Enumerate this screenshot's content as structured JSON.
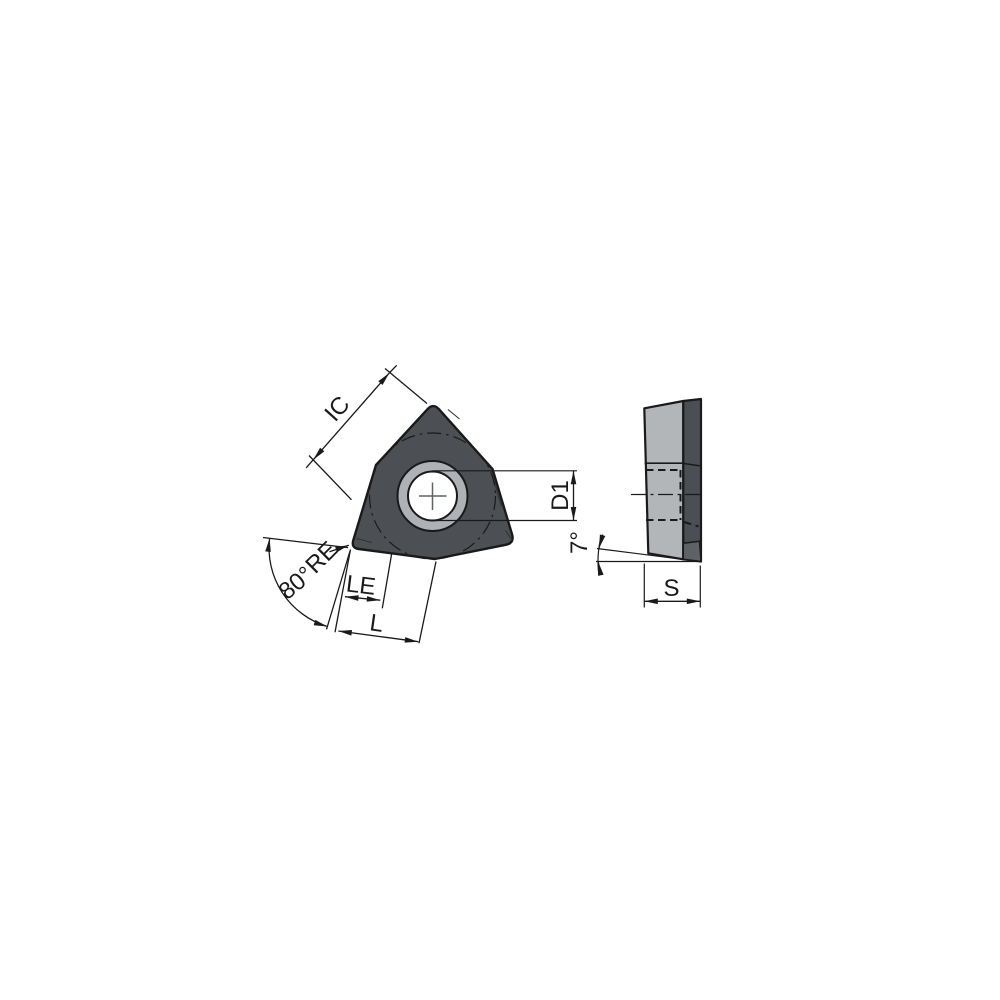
{
  "diagram": {
    "type": "technical-drawing",
    "subject": "trigon turning insert, front view and side view with dimension annotations",
    "front_view": {
      "labels": {
        "ic": "IC",
        "d1": "D1",
        "re": "RE",
        "corner_angle": "80°",
        "le": "LE",
        "l": "L"
      }
    },
    "side_view": {
      "labels": {
        "clearance_angle": "7°",
        "s": "S"
      }
    },
    "colors": {
      "insert_body": "#4c5054",
      "hole_chamfer_ring": "#aeb2b6",
      "hole": "#ffffff",
      "side_face": "#b3b6b9",
      "side_edge_face": "#4b4f53",
      "side_edge_bottom_facet": "#5e6266",
      "outline": "#1a1a1a",
      "background": "#ffffff"
    }
  }
}
